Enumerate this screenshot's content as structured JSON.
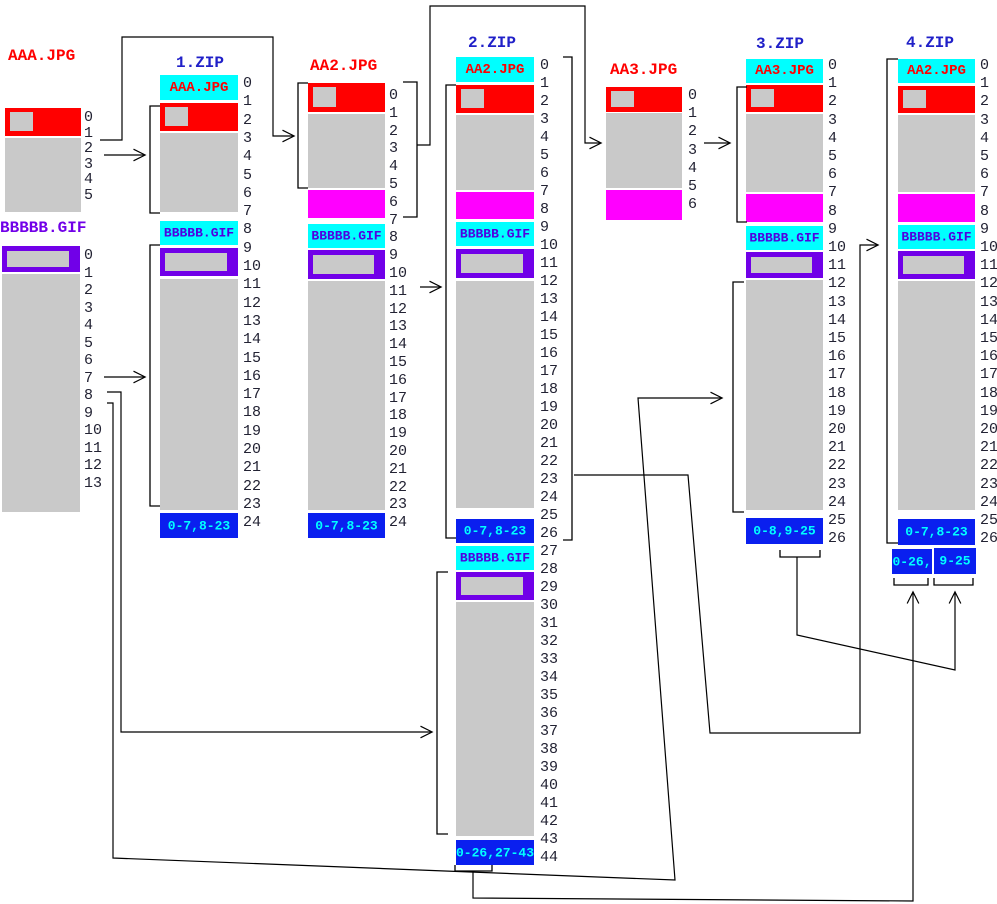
{
  "diagram": {
    "colors": {
      "red": "#FF0000",
      "gray": "#C9C9C9",
      "magenta": "#FF00FF",
      "cyan": "#00FFFF",
      "purple": "#7100E8",
      "blue": "#0A1FEF",
      "title_red": "#FF0000",
      "title_blue": "#2020C8",
      "title_purple": "#7100E8",
      "header_purple_text": "#5000E0",
      "footer_text": "#00FFFF",
      "number_text": "#222233",
      "line": "#000000"
    },
    "titles": [
      {
        "name": "aaa-jpg-title",
        "text": "AAA.JPG",
        "color": "title_red",
        "x": 8,
        "y": 48
      },
      {
        "name": "bbbbb-gif-title",
        "text": "BBBBB.GIF",
        "color": "title_purple",
        "x": 0,
        "y": 220
      },
      {
        "name": "zip1-title",
        "text": "1.ZIP",
        "color": "title_blue",
        "x": 176,
        "y": 55
      },
      {
        "name": "aa2-jpg-title",
        "text": "AA2.JPG",
        "color": "title_red",
        "x": 310,
        "y": 58
      },
      {
        "name": "zip2-title",
        "text": "2.ZIP",
        "color": "title_blue",
        "x": 468,
        "y": 35
      },
      {
        "name": "aa3-jpg-title",
        "text": "AA3.JPG",
        "color": "title_red",
        "x": 610,
        "y": 62
      },
      {
        "name": "zip3-title",
        "text": "3.ZIP",
        "color": "title_blue",
        "x": 756,
        "y": 36
      },
      {
        "name": "zip4-title",
        "text": "4.ZIP",
        "color": "title_blue",
        "x": 906,
        "y": 35
      }
    ],
    "blocks": [
      {
        "name": "aaa-jpg-header-block",
        "x": 5,
        "y": 108,
        "w": 76,
        "h": 28,
        "fill": "red",
        "square": true
      },
      {
        "name": "aaa-jpg-data-block",
        "x": 5,
        "y": 138,
        "w": 76,
        "h": 74,
        "fill": "gray"
      },
      {
        "name": "bbbbb-gif-header-block",
        "x": 2,
        "y": 246,
        "w": 78,
        "h": 26,
        "fill": "purple",
        "inner": true
      },
      {
        "name": "bbbbb-gif-data-block",
        "x": 2,
        "y": 274,
        "w": 78,
        "h": 238,
        "fill": "gray"
      },
      {
        "name": "zip1-aaa-local-header",
        "x": 160,
        "y": 75,
        "w": 78,
        "h": 25,
        "fill": "cyan",
        "label": "AAA.JPG",
        "label_color": "red",
        "label_size": 14
      },
      {
        "name": "zip1-aaa-red",
        "x": 160,
        "y": 103,
        "w": 78,
        "h": 28,
        "fill": "red",
        "square": true
      },
      {
        "name": "zip1-aaa-data",
        "x": 160,
        "y": 133,
        "w": 78,
        "h": 79,
        "fill": "gray"
      },
      {
        "name": "zip1-gif-local-header",
        "x": 160,
        "y": 221,
        "w": 78,
        "h": 24,
        "fill": "cyan",
        "label": "BBBBB.GIF",
        "label_color": "header_purple_text",
        "label_size": 13
      },
      {
        "name": "zip1-gif-purple",
        "x": 160,
        "y": 248,
        "w": 78,
        "h": 28,
        "fill": "purple",
        "inner": true
      },
      {
        "name": "zip1-gif-data",
        "x": 160,
        "y": 279,
        "w": 78,
        "h": 231,
        "fill": "gray"
      },
      {
        "name": "zip1-central-dir",
        "x": 160,
        "y": 513,
        "w": 78,
        "h": 25,
        "fill": "blue",
        "label": "0-7,8-23",
        "label_color": "footer_text",
        "label_size": 13
      },
      {
        "name": "aa2-red",
        "x": 308,
        "y": 83,
        "w": 77,
        "h": 29,
        "fill": "red",
        "square": true
      },
      {
        "name": "aa2-data",
        "x": 308,
        "y": 114,
        "w": 77,
        "h": 74,
        "fill": "gray"
      },
      {
        "name": "aa2-new-data",
        "x": 308,
        "y": 190,
        "w": 77,
        "h": 28,
        "fill": "magenta"
      },
      {
        "name": "aa2-gif-local-header",
        "x": 308,
        "y": 224,
        "w": 77,
        "h": 24,
        "fill": "cyan",
        "label": "BBBBB.GIF",
        "label_color": "header_purple_text",
        "label_size": 13
      },
      {
        "name": "aa2-gif-purple",
        "x": 308,
        "y": 250,
        "w": 77,
        "h": 29,
        "fill": "purple",
        "inner": true
      },
      {
        "name": "aa2-gif-data",
        "x": 308,
        "y": 281,
        "w": 77,
        "h": 229,
        "fill": "gray"
      },
      {
        "name": "aa2-central-dir",
        "x": 308,
        "y": 513,
        "w": 77,
        "h": 25,
        "fill": "blue",
        "label": "0-7,8-23",
        "label_color": "footer_text",
        "label_size": 13
      },
      {
        "name": "zip2-aa2-local-header",
        "x": 456,
        "y": 57,
        "w": 78,
        "h": 25,
        "fill": "cyan",
        "label": "AA2.JPG",
        "label_color": "red",
        "label_size": 14
      },
      {
        "name": "zip2-aa2-red",
        "x": 456,
        "y": 85,
        "w": 78,
        "h": 28,
        "fill": "red",
        "square": true
      },
      {
        "name": "zip2-aa2-data",
        "x": 456,
        "y": 115,
        "w": 78,
        "h": 75,
        "fill": "gray"
      },
      {
        "name": "zip2-aa2-new-data",
        "x": 456,
        "y": 192,
        "w": 78,
        "h": 27,
        "fill": "magenta"
      },
      {
        "name": "zip2-gif-local-header",
        "x": 456,
        "y": 222,
        "w": 78,
        "h": 24,
        "fill": "cyan",
        "label": "BBBBB.GIF",
        "label_color": "header_purple_text",
        "label_size": 13
      },
      {
        "name": "zip2-gif-purple",
        "x": 456,
        "y": 249,
        "w": 78,
        "h": 29,
        "fill": "purple",
        "inner": true
      },
      {
        "name": "zip2-gif-data",
        "x": 456,
        "y": 281,
        "w": 78,
        "h": 227,
        "fill": "gray"
      },
      {
        "name": "zip2-old-central-dir",
        "x": 456,
        "y": 519,
        "w": 78,
        "h": 24,
        "fill": "blue",
        "label": "0-7,8-23",
        "label_color": "footer_text",
        "label_size": 13
      },
      {
        "name": "zip2-gif2-local-header",
        "x": 456,
        "y": 546,
        "w": 78,
        "h": 24,
        "fill": "cyan",
        "label": "BBBBB.GIF",
        "label_color": "header_purple_text",
        "label_size": 13
      },
      {
        "name": "zip2-gif2-purple",
        "x": 456,
        "y": 572,
        "w": 78,
        "h": 28,
        "fill": "purple",
        "inner": true
      },
      {
        "name": "zip2-gif2-data",
        "x": 456,
        "y": 602,
        "w": 78,
        "h": 234,
        "fill": "gray"
      },
      {
        "name": "zip2-central-dir",
        "x": 456,
        "y": 840,
        "w": 78,
        "h": 25,
        "fill": "blue",
        "label": "0-26,27-43",
        "label_color": "footer_text",
        "label_size": 13
      },
      {
        "name": "aa3-red",
        "x": 606,
        "y": 87,
        "w": 76,
        "h": 25,
        "fill": "red",
        "square": true
      },
      {
        "name": "aa3-data",
        "x": 606,
        "y": 113,
        "w": 76,
        "h": 75,
        "fill": "gray"
      },
      {
        "name": "aa3-new-data",
        "x": 606,
        "y": 190,
        "w": 76,
        "h": 30,
        "fill": "magenta"
      },
      {
        "name": "zip3-aa3-local-header",
        "x": 746,
        "y": 59,
        "w": 77,
        "h": 24,
        "fill": "cyan",
        "label": "AA3.JPG",
        "label_color": "red",
        "label_size": 14
      },
      {
        "name": "zip3-aa3-red",
        "x": 746,
        "y": 85,
        "w": 77,
        "h": 27,
        "fill": "red",
        "square": true
      },
      {
        "name": "zip3-aa3-data",
        "x": 746,
        "y": 114,
        "w": 77,
        "h": 78,
        "fill": "gray"
      },
      {
        "name": "zip3-aa3-new-data",
        "x": 746,
        "y": 194,
        "w": 77,
        "h": 28,
        "fill": "magenta"
      },
      {
        "name": "zip3-gif-local-header",
        "x": 746,
        "y": 226,
        "w": 77,
        "h": 24,
        "fill": "cyan",
        "label": "BBBBB.GIF",
        "label_color": "header_purple_text",
        "label_size": 13
      },
      {
        "name": "zip3-gif-purple",
        "x": 746,
        "y": 252,
        "w": 77,
        "h": 26,
        "fill": "purple",
        "inner": true
      },
      {
        "name": "zip3-gif-data",
        "x": 746,
        "y": 280,
        "w": 77,
        "h": 230,
        "fill": "gray"
      },
      {
        "name": "zip3-central-dir",
        "x": 746,
        "y": 518,
        "w": 77,
        "h": 26,
        "fill": "blue",
        "label": "0-8,9-25",
        "label_color": "footer_text",
        "label_size": 13
      },
      {
        "name": "zip4-aa2-local-header",
        "x": 898,
        "y": 59,
        "w": 77,
        "h": 24,
        "fill": "cyan",
        "label": "AA2.JPG",
        "label_color": "red",
        "label_size": 14
      },
      {
        "name": "zip4-aa2-red",
        "x": 898,
        "y": 86,
        "w": 77,
        "h": 27,
        "fill": "red",
        "square": true
      },
      {
        "name": "zip4-aa2-data",
        "x": 898,
        "y": 115,
        "w": 77,
        "h": 77,
        "fill": "gray"
      },
      {
        "name": "zip4-aa2-new-data",
        "x": 898,
        "y": 194,
        "w": 77,
        "h": 28,
        "fill": "magenta"
      },
      {
        "name": "zip4-gif-local-header",
        "x": 898,
        "y": 225,
        "w": 77,
        "h": 24,
        "fill": "cyan",
        "label": "BBBBB.GIF",
        "label_color": "header_purple_text",
        "label_size": 13
      },
      {
        "name": "zip4-gif-purple",
        "x": 898,
        "y": 251,
        "w": 77,
        "h": 28,
        "fill": "purple",
        "inner": true
      },
      {
        "name": "zip4-gif-data",
        "x": 898,
        "y": 281,
        "w": 77,
        "h": 229,
        "fill": "gray"
      },
      {
        "name": "zip4-old-central-dir",
        "x": 898,
        "y": 519,
        "w": 77,
        "h": 26,
        "fill": "blue",
        "label": "0-7,8-23",
        "label_color": "footer_text",
        "label_size": 13
      },
      {
        "name": "zip4-cd-part1",
        "x": 892,
        "y": 549,
        "w": 40,
        "h": 25,
        "fill": "blue",
        "label": "0-26,",
        "label_color": "footer_text",
        "label_size": 13
      },
      {
        "name": "zip4-cd-part2",
        "x": 934,
        "y": 548,
        "w": 42,
        "h": 26,
        "fill": "blue",
        "label": "9-25",
        "label_color": "footer_text",
        "label_size": 13
      }
    ],
    "number_runs": [
      {
        "name": "aaa-jpg-offsets",
        "x": 84,
        "y0": 110,
        "step": 15.6,
        "from": 0,
        "to": 5
      },
      {
        "name": "bbbbb-gif-offsets",
        "x": 84,
        "y0": 248,
        "step": 17.5,
        "from": 0,
        "to": 13
      },
      {
        "name": "zip1-offsets",
        "x": 243,
        "y0": 76,
        "step": 18.3,
        "from": 0,
        "to": 24
      },
      {
        "name": "aa2-offsets",
        "x": 389,
        "y0": 88,
        "step": 17.8,
        "from": 0,
        "to": 24
      },
      {
        "name": "zip2-offsets",
        "x": 540,
        "y0": 58,
        "step": 18.0,
        "from": 0,
        "to": 44
      },
      {
        "name": "aa3-offsets",
        "x": 688,
        "y0": 88,
        "step": 18.2,
        "from": 0,
        "to": 6
      },
      {
        "name": "zip3-offsets",
        "x": 828,
        "y0": 58,
        "step": 18.2,
        "from": 0,
        "to": 26
      },
      {
        "name": "zip4-offsets",
        "x": 980,
        "y0": 58,
        "step": 18.2,
        "from": 0,
        "to": 26
      }
    ],
    "brackets": [
      {
        "name": "zip1-jpg-bracket",
        "d": "M160,106 H150 V213 H160"
      },
      {
        "name": "zip1-gif-bracket",
        "d": "M160,245 H150 V506 H160"
      },
      {
        "name": "aa2-left-bracket",
        "d": "M308,83 H298 V188 H308"
      },
      {
        "name": "aa2-right-bracket",
        "d": "M403,82 H417 V217 H403"
      },
      {
        "name": "zip2-main-bracket",
        "d": "M456,85 H446 V538 H456"
      },
      {
        "name": "zip2-appended-bracket",
        "d": "M448,572 H437 V834 H448"
      },
      {
        "name": "zip2-right-bracket",
        "d": "M563,57 H572 V540 H563"
      },
      {
        "name": "zip3-jpg-bracket",
        "d": "M747,87 H737 V222 H747"
      },
      {
        "name": "zip3-gif-bracket",
        "d": "M744,282 H733 V512 H744"
      },
      {
        "name": "zip4-left-bracket",
        "d": "M898,59 H887 V543 H898"
      },
      {
        "name": "zip3-cd-underbracket",
        "d": "M780,550 V557 H820 V550"
      },
      {
        "name": "zip2-cd-underbracket",
        "d": "M455,865 V871 H492 V865"
      },
      {
        "name": "zip4-cd1-underbracket",
        "d": "M894,578 V585 H928 V578"
      },
      {
        "name": "zip4-cd2-underbracket",
        "d": "M934,578 V585 H973 V578"
      }
    ],
    "connectors": [
      {
        "name": "aaa-to-aa2-connector",
        "points": "100,140 122,140 122,37 273,37 273,136 293,136",
        "arrow": true
      },
      {
        "name": "aaa-to-zip1-arrow",
        "points": "104,155 144,155",
        "arrow": true
      },
      {
        "name": "gif-to-zip1-arrow",
        "points": "104,377 144,377",
        "arrow": true
      },
      {
        "name": "gif-to-zip2-appended-arrow",
        "points": "107,392 121,392 121,732 431,732",
        "arrow": true
      },
      {
        "name": "gif-to-zip3-arrow",
        "points": "107,403 113,403 113,858 675,880 638,398 721,398",
        "arrow": true
      },
      {
        "name": "aa2-to-zip2-arrow",
        "points": "420,287 440,287",
        "arrow": true
      },
      {
        "name": "aa2-to-aa3-connector",
        "points": "417,145 430,145 430,6 585,6 585,143 600,143",
        "arrow": true
      },
      {
        "name": "aa3-to-zip3-arrow",
        "points": "704,143 729,143",
        "arrow": true
      },
      {
        "name": "zip2-to-zip4-connector",
        "points": "574,475 688,475 710,733 860,733 860,245 877,245",
        "arrow": true
      },
      {
        "name": "zip3-cd-to-zip4-connector",
        "points": "797,557 797,635 955,670 955,593",
        "arrow": true
      },
      {
        "name": "zip2-cd-to-zip4-connector",
        "points": "473,871 473,898 913,901 913,593",
        "arrow": true
      }
    ]
  }
}
